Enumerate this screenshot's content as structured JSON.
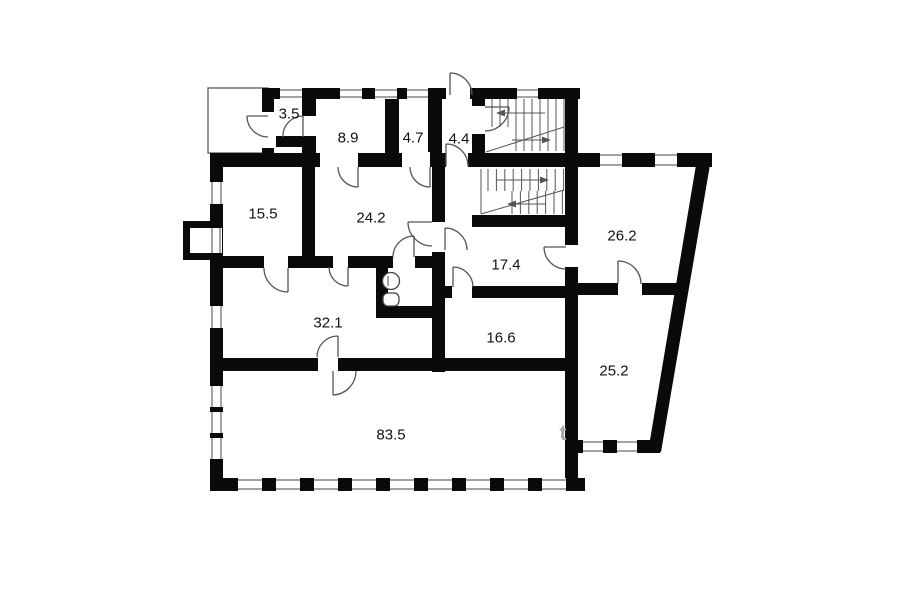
{
  "plan": {
    "type": "floor-plan",
    "colors": {
      "wall": "#0a0a0a",
      "line": "#4a4a4a",
      "label": "#111111",
      "watermark": "#a6a6a6",
      "background": "#ffffff"
    },
    "rooms": [
      {
        "id": "3-5",
        "area_label": "3.5",
        "x": 289,
        "y": 114
      },
      {
        "id": "8-9",
        "area_label": "8.9",
        "x": 348,
        "y": 138
      },
      {
        "id": "4-7",
        "area_label": "4.7",
        "x": 413,
        "y": 138
      },
      {
        "id": "4-4",
        "area_label": "4.4",
        "x": 459,
        "y": 139
      },
      {
        "id": "15-5",
        "area_label": "15.5",
        "x": 263,
        "y": 214
      },
      {
        "id": "24-2",
        "area_label": "24.2",
        "x": 371,
        "y": 218
      },
      {
        "id": "26-2",
        "area_label": "26.2",
        "x": 622,
        "y": 236
      },
      {
        "id": "17-4",
        "area_label": "17.4",
        "x": 506,
        "y": 265
      },
      {
        "id": "32-1",
        "area_label": "32.1",
        "x": 328,
        "y": 323
      },
      {
        "id": "16-6",
        "area_label": "16.6",
        "x": 501,
        "y": 338
      },
      {
        "id": "25-2",
        "area_label": "25.2",
        "x": 614,
        "y": 371
      },
      {
        "id": "83-5",
        "area_label": "83.5",
        "x": 391,
        "y": 435
      }
    ],
    "watermark": {
      "text": "t",
      "x": 563,
      "y": 440
    },
    "features": [
      "porch",
      "entrance-door",
      "upper-staircase",
      "lower-staircase",
      "toilet",
      "bay-window"
    ]
  }
}
